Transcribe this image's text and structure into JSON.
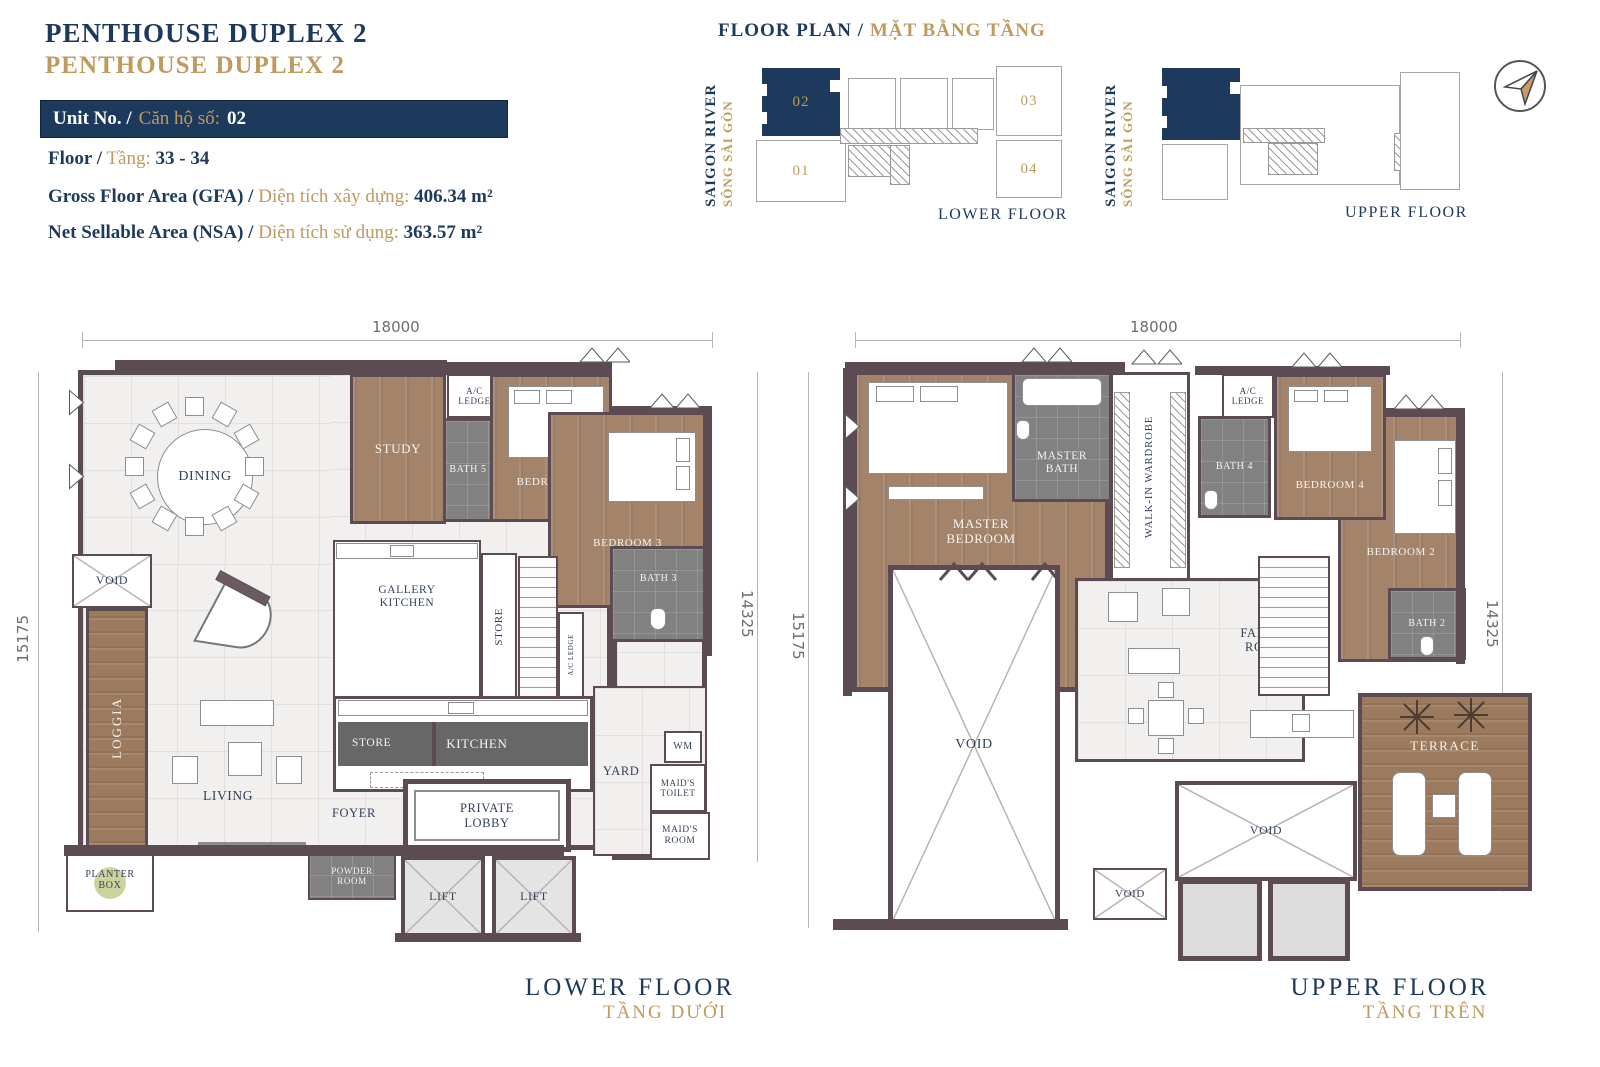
{
  "colors": {
    "navy": "#1d3a5c",
    "gold": "#bf9a5c",
    "wall": "#5d4b54",
    "wood": "#a3846a"
  },
  "header": {
    "title_en": "PENTHOUSE DUPLEX 2",
    "title_vi": "PENTHOUSE DUPLEX 2",
    "unit_label_en": "Unit No. /",
    "unit_label_vi": "Căn hộ số:",
    "unit_value": "02",
    "floor_label_en": "Floor /",
    "floor_label_vi": "Tầng:",
    "floor_value": "33 - 34",
    "gfa_label_en": "Gross Floor Area (GFA) /",
    "gfa_label_vi": "Diện tích xây dựng:",
    "gfa_value": "406.34 m²",
    "nsa_label_en": "Net Sellable Area (NSA) /",
    "nsa_label_vi": "Diện tích sử dụng:",
    "nsa_value": "363.57 m²"
  },
  "keyplan": {
    "title_en": "FLOOR PLAN /",
    "title_vi": "MẶT BẰNG TẦNG",
    "river_en": "SAIGON RIVER",
    "river_vi": "SÔNG SÀI GÒN",
    "lower_caption": "LOWER FLOOR",
    "upper_caption": "UPPER FLOOR",
    "units": {
      "u01": "01",
      "u02": "02",
      "u03": "03",
      "u04": "04"
    }
  },
  "lower_plan": {
    "caption_en": "LOWER FLOOR",
    "caption_vi": "TẦNG DƯỚI",
    "dims": {
      "top": "18000",
      "left": "15175",
      "right": "14325"
    },
    "rooms": {
      "dining": "DINING",
      "void": "VOID",
      "loggia": "LOGGIA",
      "planter_box": "PLANTER BOX",
      "living": "LIVING",
      "foyer": "FOYER",
      "study": "STUDY",
      "bath5": "BATH 5",
      "bedroom5": "BEDROOM 5",
      "ac_ledge": "A/C LEDGE",
      "bedroom3": "BEDROOM 3",
      "bath3": "BATH 3",
      "gallery_kitchen": "GALLERY KITCHEN",
      "store": "STORE",
      "kitchen": "KITCHEN",
      "yard": "YARD",
      "wm": "WM",
      "maids_toilet": "MAID'S TOILET",
      "maids_room": "MAID'S ROOM",
      "private_lobby": "PRIVATE LOBBY",
      "powder_room": "POWDER ROOM",
      "lift": "LIFT"
    }
  },
  "upper_plan": {
    "caption_en": "UPPER FLOOR",
    "caption_vi": "TẦNG TRÊN",
    "dims": {
      "top": "18000",
      "left": "15175",
      "right": "14325"
    },
    "rooms": {
      "master_bedroom": "MASTER BEDROOM",
      "master_bath": "MASTER BATH",
      "walkin_wardrobe": "WALK-IN WARDROBE",
      "ac_ledge": "A/C LEDGE",
      "bath4": "BATH 4",
      "bedroom4": "BEDROOM 4",
      "bedroom2": "BEDROOM 2",
      "bath2": "BATH 2",
      "family_room": "FAMILY ROOM",
      "void": "VOID",
      "terrace": "TERRACE"
    }
  }
}
